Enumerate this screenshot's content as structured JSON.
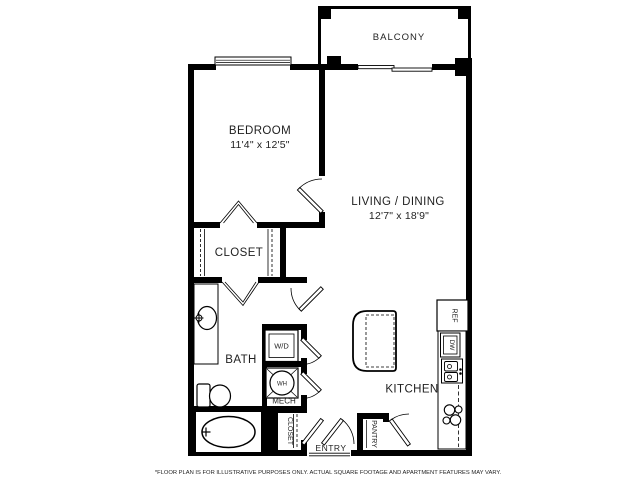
{
  "floor_plan": {
    "balcony": "BALCONY",
    "bedroom": {
      "name": "BEDROOM",
      "dims": "11'4\" x 12'5\""
    },
    "living_dining": {
      "name": "LIVING / DINING",
      "dims": "12'7\" x 18'9\""
    },
    "walk_in_closet": "CLOSET",
    "bath": "BATH",
    "washer_dryer": "W/D",
    "water_heater": "WH",
    "mech": "MECH",
    "entry_closet": "CLOSET",
    "entry": "ENTRY",
    "pantry": "PANTRY",
    "kitchen": "KITCHEN",
    "fridge": "REF",
    "dishwasher": "DW"
  },
  "footer": {
    "disclaimer": "*FLOOR PLAN IS FOR ILLUSTRATIVE PURPOSES ONLY. ACTUAL SQUARE FOOTAGE AND APARTMENT FEATURES MAY VARY."
  },
  "colors": {
    "walls": "#000000",
    "text": "#1f1f1f",
    "background": "#ffffff"
  }
}
